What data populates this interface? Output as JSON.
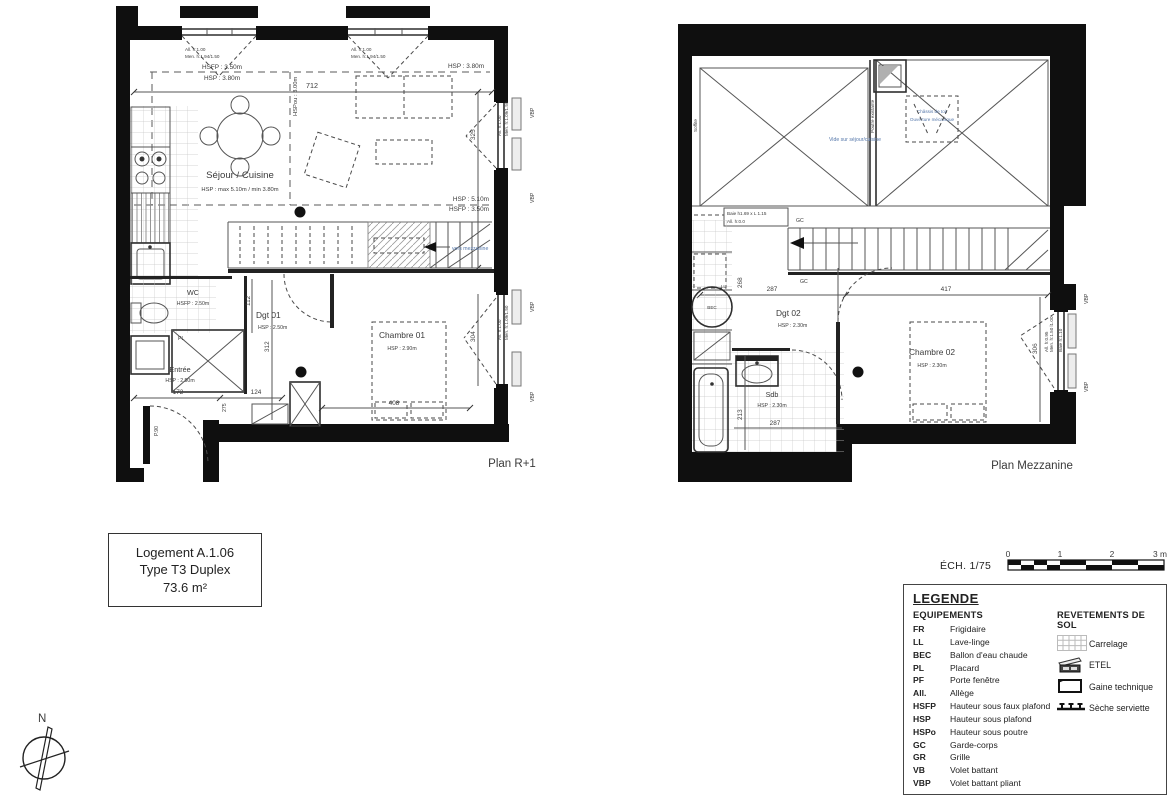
{
  "r1": {
    "title": "Plan R+1",
    "sejour": "Séjour / Cuisine",
    "sejour_h": "HSP : max 5.10m / min 3.80m",
    "hsfp_top": "HSFP : 3.50m",
    "hsp_top": "HSP : 3.80m",
    "hsp_tr": "HSP : 3.80m",
    "hspou": "HSPou : 3.00m",
    "hsp_r": "HSP : 5.10m",
    "hsfp_r": "HSFP : 3.50m",
    "win_all": "All. h:1.00",
    "win_men": "Men. h:1.94/1.50",
    "win_r_all": "All. h:1.00",
    "win_r_men": "Men. h:1.09/1.50",
    "wc": "WC",
    "wc_h": "HSFP : 2.50m",
    "dgt": "Dgt 01",
    "dgt_h": "HSP : 2.50m",
    "ch": "Chambre 01",
    "ch_h": "HSP : 2.90m",
    "entree": "Entrée",
    "entree_h": "HSP : 2.50m",
    "pl": "PL",
    "p90": "P.90",
    "vers": "vers mezzanine",
    "vbp": "VBP",
    "d712": "712",
    "d325": "325",
    "d312": "312",
    "d304": "304",
    "d112": "112",
    "d172": "172",
    "d124": "124",
    "d408": "408",
    "d275": "275"
  },
  "mz": {
    "title": "Plan Mezzanine",
    "soffite": "Soffite",
    "poutre": "Poutre existante",
    "vide": "Vide sur séjour/cuisine",
    "chassis1": "Châssis de toit",
    "chassis2": "Ouverture mécanique",
    "baie": "Baie h1.69 x L 1.15",
    "all0": "All. h:0.0",
    "gc": "GC",
    "dgt": "Dgt 02",
    "dgt_h": "HSP : 2.30m",
    "ch": "Chambre 02",
    "ch_h": "HSP : 2.30m",
    "sdb": "Sdb",
    "sdb_h": "HSP : 2.30m",
    "bec": "BEC",
    "ll": "LL",
    "vbp": "VBP",
    "w_all": "All. h:0.95",
    "w_men": "Men. h:1.50 l1.00",
    "w_baie": "Baie h:1.10",
    "d287a": "287",
    "d417": "417",
    "d268": "268",
    "d213": "213",
    "d287b": "287",
    "d306": "306"
  },
  "title_block": {
    "l1": "Logement A.1.06",
    "l2": "Type T3 Duplex",
    "l3": "73.6 m²"
  },
  "scale": {
    "label": "ÉCH. 1/75",
    "t0": "0",
    "t1": "1",
    "t2": "2",
    "t3": "3 m"
  },
  "north": {
    "label": "N"
  },
  "legend": {
    "title": "LEGENDE",
    "equip_title": "EQUIPEMENTS",
    "revet_title": "REVETEMENTS DE SOL",
    "equip": [
      {
        "abbr": "FR",
        "label": "Frigidaire"
      },
      {
        "abbr": "LL",
        "label": "Lave-linge"
      },
      {
        "abbr": "BEC",
        "label": "Ballon d'eau chaude"
      },
      {
        "abbr": "PL",
        "label": "Placard"
      },
      {
        "abbr": "PF",
        "label": "Porte fenêtre"
      },
      {
        "abbr": "All.",
        "label": "Allège"
      },
      {
        "abbr": "HSFP",
        "label": "Hauteur sous faux plafond"
      },
      {
        "abbr": "HSP",
        "label": "Hauteur sous plafond"
      },
      {
        "abbr": "HSPo",
        "label": "Hauteur sous poutre"
      },
      {
        "abbr": "GC",
        "label": "Garde-corps"
      },
      {
        "abbr": "GR",
        "label": "Grille"
      },
      {
        "abbr": "VB",
        "label": "Volet battant"
      },
      {
        "abbr": "VBP",
        "label": "Volet battant pliant"
      }
    ],
    "revet": [
      {
        "label": "Carrelage"
      },
      {
        "label": "ETEL"
      },
      {
        "label": "Gaine technique"
      },
      {
        "label": "Sèche serviette"
      }
    ]
  },
  "colors": {
    "annotation_blue": "#5577aa",
    "wall_black": "#0f0f0f"
  }
}
